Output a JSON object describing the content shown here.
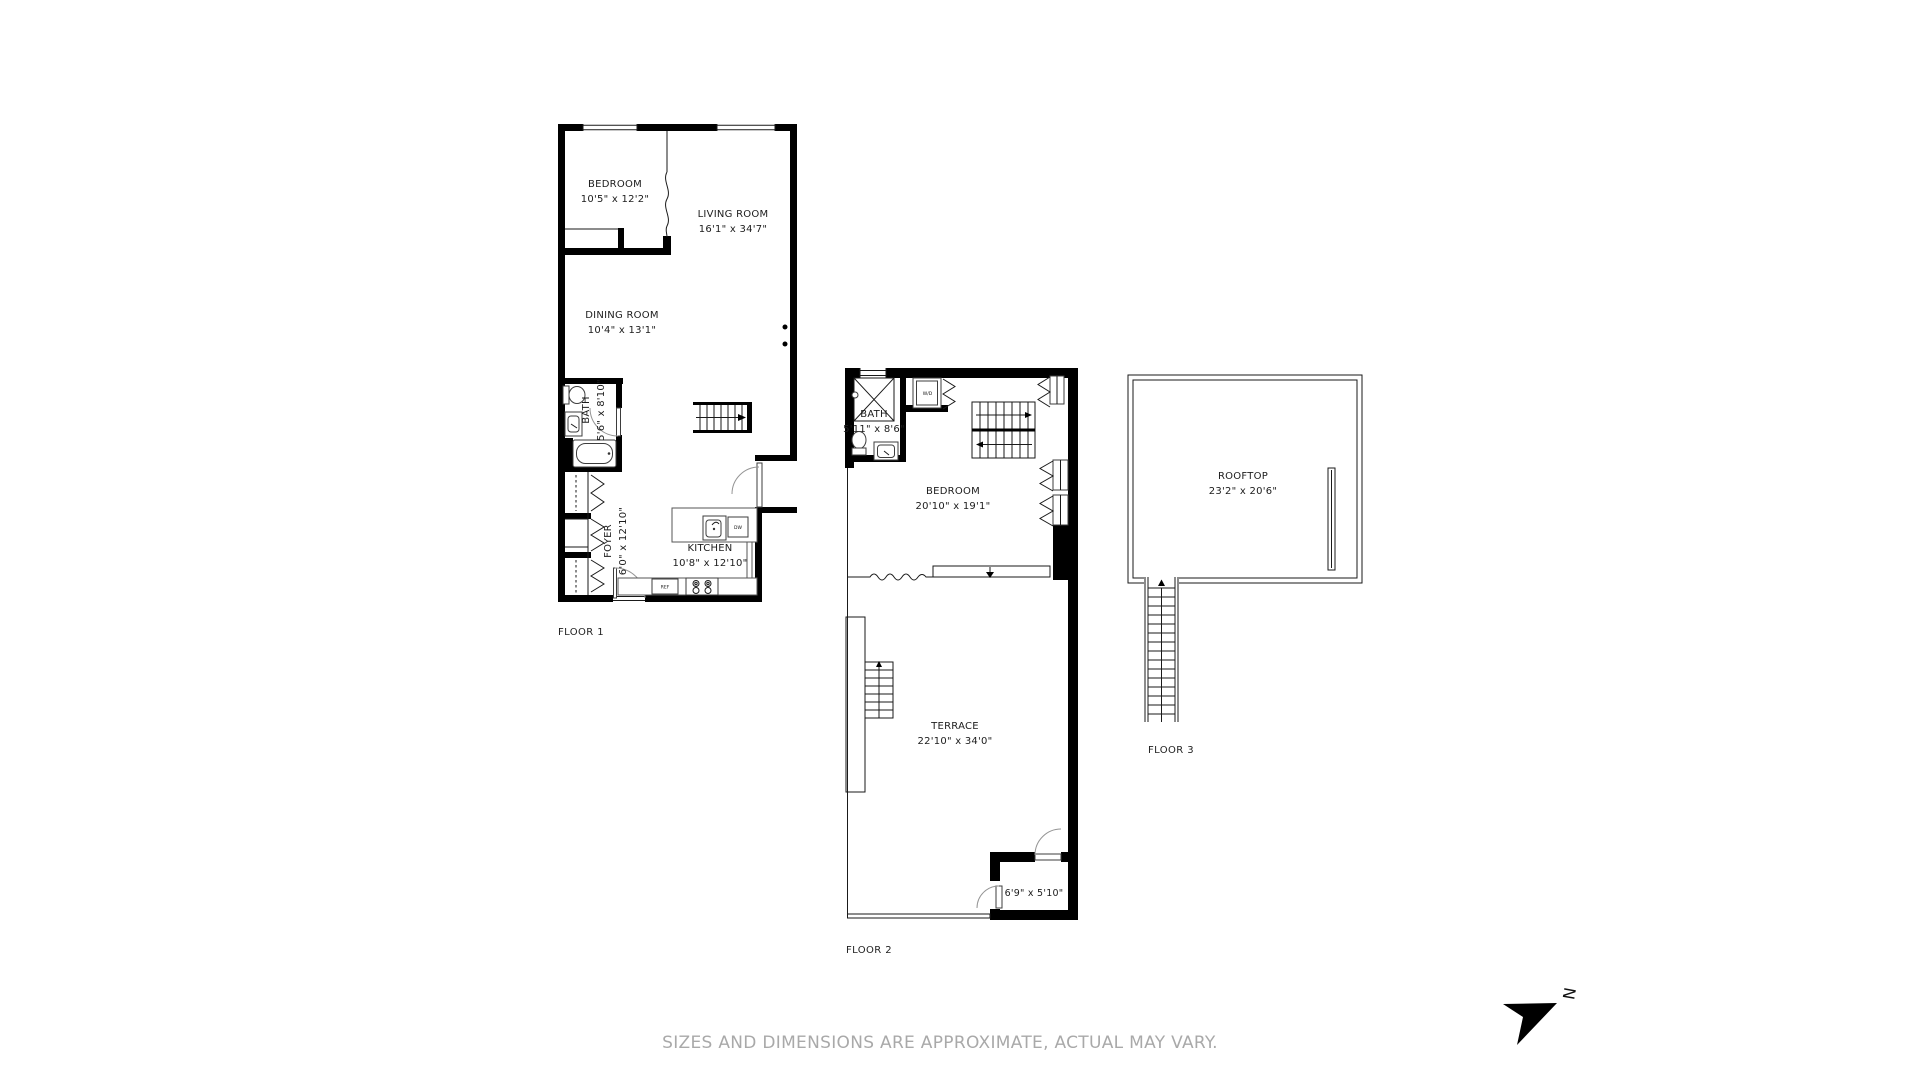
{
  "disclaimer": "SIZES AND DIMENSIONS ARE APPROXIMATE, ACTUAL MAY VARY.",
  "compass": {
    "north_label": "N"
  },
  "colors": {
    "wall": "#000000",
    "door": "#949494",
    "muted_text": "#a9a9a9"
  },
  "floor1": {
    "name": "FLOOR 1",
    "rooms": {
      "bedroom": {
        "label": "BEDROOM",
        "dims": "10'5\" x 12'2\""
      },
      "living_room": {
        "label": "LIVING ROOM",
        "dims": "16'1\" x 34'7\""
      },
      "dining_room": {
        "label": "DINING ROOM",
        "dims": "10'4\" x 13'1\""
      },
      "bath": {
        "label": "BATH",
        "dims": "5'6\" x 8'10\""
      },
      "foyer": {
        "label": "FOYER",
        "dims": "6'0\" x 12'10\""
      },
      "kitchen": {
        "label": "KITCHEN",
        "dims": "10'8\" x 12'10\""
      }
    },
    "appliances": {
      "refrigerator": "REF",
      "dishwasher": "DW"
    }
  },
  "floor2": {
    "name": "FLOOR 2",
    "rooms": {
      "bath": {
        "label": "BATH",
        "dims": "5'11\" x 8'6\""
      },
      "bedroom": {
        "label": "BEDROOM",
        "dims": "20'10\" x 19'1\""
      },
      "terrace": {
        "label": "TERRACE",
        "dims": "22'10\" x 34'0\""
      },
      "storage": {
        "dims": "6'9\" x 5'10\""
      }
    },
    "appliances": {
      "washer_dryer": "W/D"
    }
  },
  "floor3": {
    "name": "FLOOR 3",
    "rooms": {
      "rooftop": {
        "label": "ROOFTOP",
        "dims": "23'2\" x 20'6\""
      }
    }
  }
}
